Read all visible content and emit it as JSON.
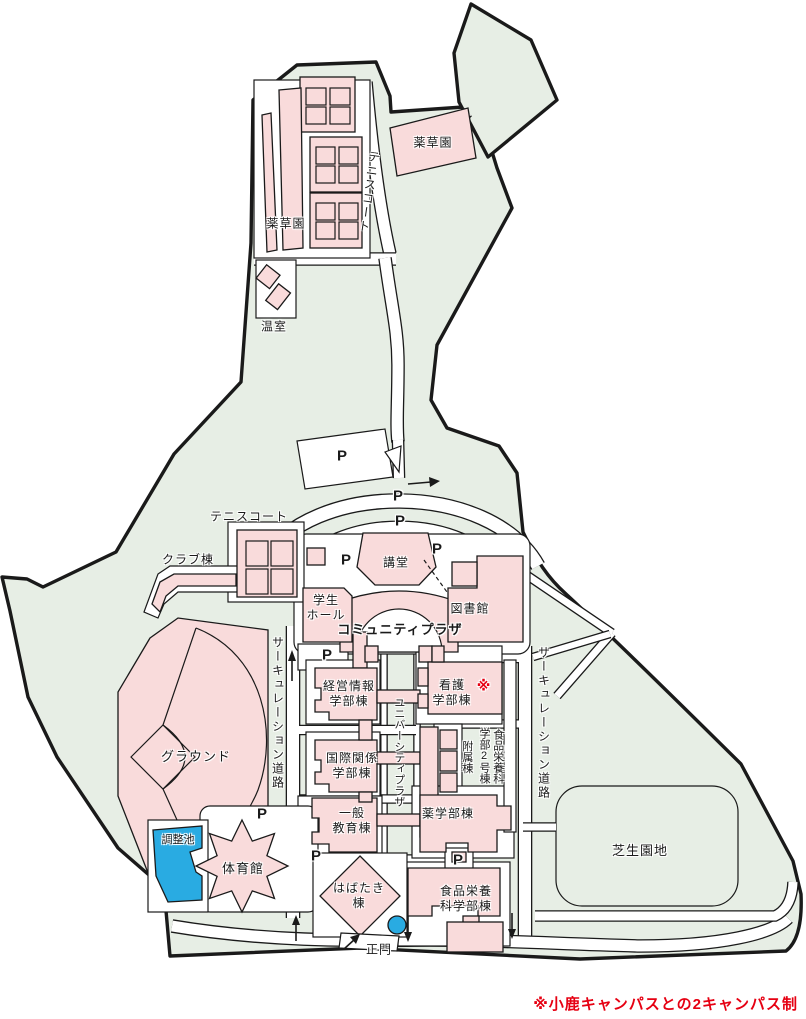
{
  "colors": {
    "campus_green": "#e7eee5",
    "building_pink": "#f9dbdb",
    "pond_blue": "#29abe2",
    "note_red": "#e60012",
    "outline_black": "#1a1a1a",
    "road_white": "#ffffff"
  },
  "labels": {
    "herb_garden": "薬草園",
    "tennis_court": "テニスコート",
    "greenhouse": "温室",
    "parking": "P",
    "club_building": "クラブ棟",
    "auditorium": "講堂",
    "student_hall": "学生\nホール",
    "library": "図書館",
    "community_plaza": "コミュニティプラザ",
    "ground": "グラウンド",
    "circulation_road": "サーキュレーション道路",
    "university_plaza": "ユニバーシティプラザ",
    "management_info": "経営情報\n学部棟",
    "nursing": "看護\n学部棟",
    "ref_mark": "※",
    "food_nutrition_no2": "食品栄養科\n学部2号棟",
    "annex": "附属棟",
    "international_relations": "国際関係\n学部棟",
    "general_education": "一般\n教育棟",
    "pharmacy": "薬学部棟",
    "lawn": "芝生園地",
    "pond": "調整池",
    "gymnasium": "体育館",
    "habataki": "はばたき\n棟",
    "food_nutrition": "食品栄養\n科学部棟",
    "main_gate": "正門",
    "note": "※小鹿キャンパスとの2キャンパス制"
  }
}
